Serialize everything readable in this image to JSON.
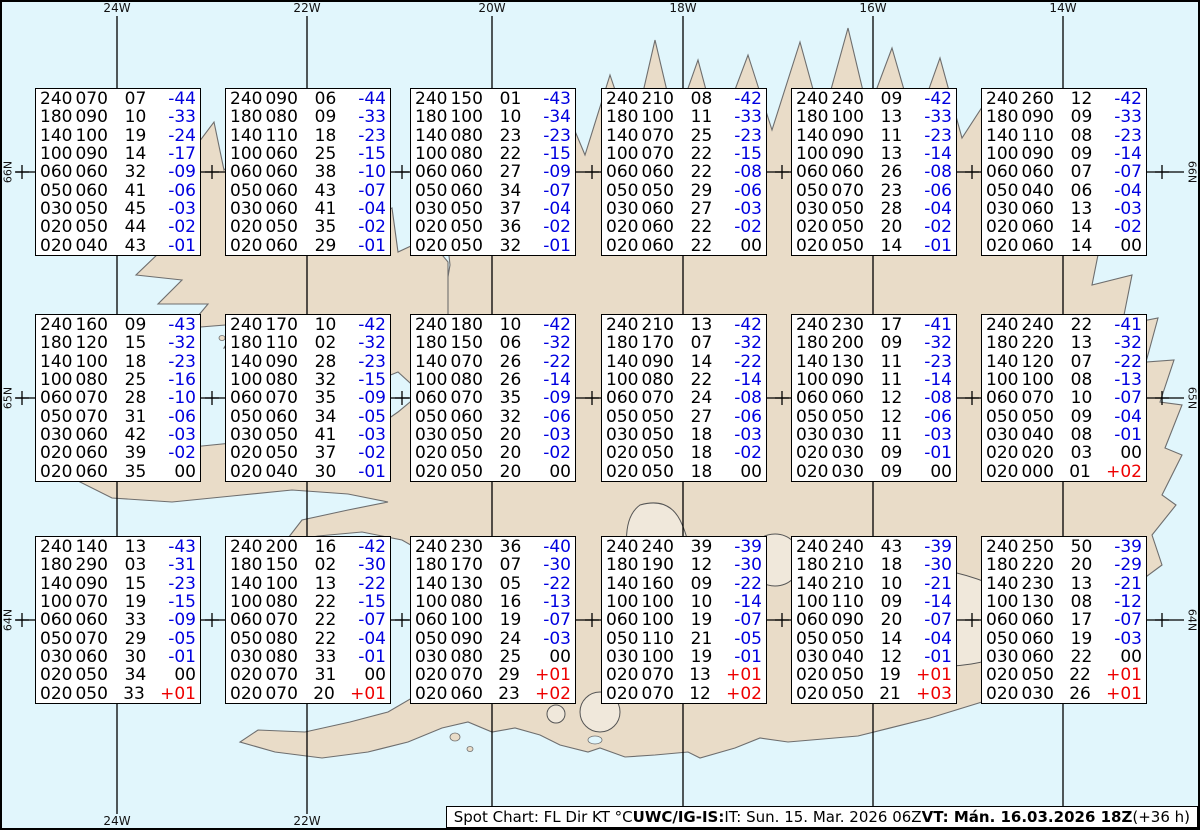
{
  "colors": {
    "ocean": "#e1f6fc",
    "land": "#e9dcc8",
    "coast": "#6e6e6e",
    "grid": "#000000",
    "temp_negative": "#0000e0",
    "temp_positive": "#ee0000",
    "temp_zero": "#000000",
    "box_background": "#ffffff",
    "box_border": "#000000"
  },
  "axis": {
    "meridians": [
      {
        "label": "24W",
        "x": 117
      },
      {
        "label": "22W",
        "x": 307
      },
      {
        "label": "20W",
        "x": 492
      },
      {
        "label": "18W",
        "x": 683
      },
      {
        "label": "16W",
        "x": 873
      },
      {
        "label": "14W",
        "x": 1063
      }
    ],
    "parallels": [
      {
        "label": "66N",
        "y": 172
      },
      {
        "label": "65N",
        "y": 398
      },
      {
        "label": "64N",
        "y": 620
      }
    ],
    "minor_cross_xs": [
      22,
      212,
      402,
      592,
      782,
      972,
      1162
    ]
  },
  "chart_data": {
    "type": "table",
    "title": "Spot Chart: FL Dir KT °C",
    "columns": [
      "FL",
      "Dir",
      "KT",
      "°C"
    ],
    "lon_labels": [
      "24W",
      "22W",
      "20W",
      "18W",
      "16W",
      "14W"
    ],
    "lat_labels": [
      "66N",
      "65N",
      "64N"
    ],
    "boxes": [
      {
        "lat": "66N",
        "lon": "24W",
        "rows": [
          [
            "240",
            "070",
            "07",
            "-44"
          ],
          [
            "180",
            "090",
            "10",
            "-33"
          ],
          [
            "140",
            "100",
            "19",
            "-24"
          ],
          [
            "100",
            "090",
            "14",
            "-17"
          ],
          [
            "060",
            "060",
            "32",
            "-09"
          ],
          [
            "050",
            "060",
            "41",
            "-06"
          ],
          [
            "030",
            "050",
            "45",
            "-03"
          ],
          [
            "020",
            "050",
            "44",
            "-02"
          ],
          [
            "020",
            "040",
            "43",
            "-01"
          ]
        ]
      },
      {
        "lat": "66N",
        "lon": "22W",
        "rows": [
          [
            "240",
            "090",
            "06",
            "-44"
          ],
          [
            "180",
            "080",
            "09",
            "-33"
          ],
          [
            "140",
            "110",
            "18",
            "-23"
          ],
          [
            "100",
            "060",
            "25",
            "-15"
          ],
          [
            "060",
            "060",
            "38",
            "-10"
          ],
          [
            "050",
            "060",
            "43",
            "-07"
          ],
          [
            "030",
            "060",
            "41",
            "-04"
          ],
          [
            "020",
            "050",
            "35",
            "-02"
          ],
          [
            "020",
            "060",
            "29",
            "-01"
          ]
        ]
      },
      {
        "lat": "66N",
        "lon": "20W",
        "rows": [
          [
            "240",
            "150",
            "01",
            "-43"
          ],
          [
            "180",
            "100",
            "10",
            "-34"
          ],
          [
            "140",
            "080",
            "23",
            "-23"
          ],
          [
            "100",
            "080",
            "22",
            "-15"
          ],
          [
            "060",
            "060",
            "27",
            "-09"
          ],
          [
            "050",
            "060",
            "34",
            "-07"
          ],
          [
            "030",
            "050",
            "37",
            "-04"
          ],
          [
            "020",
            "050",
            "36",
            "-02"
          ],
          [
            "020",
            "050",
            "32",
            "-01"
          ]
        ]
      },
      {
        "lat": "66N",
        "lon": "18W",
        "rows": [
          [
            "240",
            "210",
            "08",
            "-42"
          ],
          [
            "180",
            "100",
            "11",
            "-33"
          ],
          [
            "140",
            "070",
            "25",
            "-23"
          ],
          [
            "100",
            "070",
            "22",
            "-15"
          ],
          [
            "060",
            "060",
            "22",
            "-08"
          ],
          [
            "050",
            "050",
            "29",
            "-06"
          ],
          [
            "030",
            "060",
            "27",
            "-03"
          ],
          [
            "020",
            "060",
            "22",
            "-02"
          ],
          [
            "020",
            "060",
            "22",
            "00"
          ]
        ]
      },
      {
        "lat": "66N",
        "lon": "16W",
        "rows": [
          [
            "240",
            "240",
            "09",
            "-42"
          ],
          [
            "180",
            "100",
            "13",
            "-33"
          ],
          [
            "140",
            "090",
            "11",
            "-23"
          ],
          [
            "100",
            "090",
            "13",
            "-14"
          ],
          [
            "060",
            "060",
            "26",
            "-08"
          ],
          [
            "050",
            "070",
            "23",
            "-06"
          ],
          [
            "030",
            "050",
            "28",
            "-04"
          ],
          [
            "020",
            "050",
            "20",
            "-02"
          ],
          [
            "020",
            "050",
            "14",
            "-01"
          ]
        ]
      },
      {
        "lat": "66N",
        "lon": "14W",
        "rows": [
          [
            "240",
            "260",
            "12",
            "-42"
          ],
          [
            "180",
            "090",
            "09",
            "-33"
          ],
          [
            "140",
            "110",
            "08",
            "-23"
          ],
          [
            "100",
            "090",
            "09",
            "-14"
          ],
          [
            "060",
            "060",
            "07",
            "-07"
          ],
          [
            "050",
            "040",
            "06",
            "-04"
          ],
          [
            "030",
            "060",
            "13",
            "-03"
          ],
          [
            "020",
            "060",
            "14",
            "-02"
          ],
          [
            "020",
            "060",
            "14",
            "00"
          ]
        ]
      },
      {
        "lat": "65N",
        "lon": "24W",
        "rows": [
          [
            "240",
            "160",
            "09",
            "-43"
          ],
          [
            "180",
            "120",
            "15",
            "-32"
          ],
          [
            "140",
            "100",
            "18",
            "-23"
          ],
          [
            "100",
            "080",
            "25",
            "-16"
          ],
          [
            "060",
            "070",
            "28",
            "-10"
          ],
          [
            "050",
            "070",
            "31",
            "-06"
          ],
          [
            "030",
            "060",
            "42",
            "-03"
          ],
          [
            "020",
            "060",
            "39",
            "-02"
          ],
          [
            "020",
            "060",
            "35",
            "00"
          ]
        ]
      },
      {
        "lat": "65N",
        "lon": "22W",
        "rows": [
          [
            "240",
            "170",
            "10",
            "-42"
          ],
          [
            "180",
            "110",
            "02",
            "-32"
          ],
          [
            "140",
            "090",
            "28",
            "-23"
          ],
          [
            "100",
            "080",
            "32",
            "-15"
          ],
          [
            "060",
            "070",
            "35",
            "-09"
          ],
          [
            "050",
            "060",
            "34",
            "-05"
          ],
          [
            "030",
            "050",
            "41",
            "-03"
          ],
          [
            "020",
            "050",
            "37",
            "-02"
          ],
          [
            "020",
            "040",
            "30",
            "-01"
          ]
        ]
      },
      {
        "lat": "65N",
        "lon": "20W",
        "rows": [
          [
            "240",
            "180",
            "10",
            "-42"
          ],
          [
            "180",
            "150",
            "06",
            "-32"
          ],
          [
            "140",
            "070",
            "26",
            "-22"
          ],
          [
            "100",
            "080",
            "26",
            "-14"
          ],
          [
            "060",
            "070",
            "35",
            "-09"
          ],
          [
            "050",
            "060",
            "32",
            "-06"
          ],
          [
            "030",
            "050",
            "20",
            "-03"
          ],
          [
            "020",
            "050",
            "20",
            "-02"
          ],
          [
            "020",
            "050",
            "20",
            "00"
          ]
        ]
      },
      {
        "lat": "65N",
        "lon": "18W",
        "rows": [
          [
            "240",
            "210",
            "13",
            "-42"
          ],
          [
            "180",
            "170",
            "07",
            "-32"
          ],
          [
            "140",
            "090",
            "14",
            "-22"
          ],
          [
            "100",
            "080",
            "22",
            "-14"
          ],
          [
            "060",
            "070",
            "24",
            "-08"
          ],
          [
            "050",
            "050",
            "27",
            "-06"
          ],
          [
            "030",
            "050",
            "18",
            "-03"
          ],
          [
            "020",
            "050",
            "18",
            "-02"
          ],
          [
            "020",
            "050",
            "18",
            "00"
          ]
        ]
      },
      {
        "lat": "65N",
        "lon": "16W",
        "rows": [
          [
            "240",
            "230",
            "17",
            "-41"
          ],
          [
            "180",
            "200",
            "09",
            "-32"
          ],
          [
            "140",
            "130",
            "11",
            "-23"
          ],
          [
            "100",
            "090",
            "11",
            "-14"
          ],
          [
            "060",
            "060",
            "12",
            "-08"
          ],
          [
            "050",
            "050",
            "12",
            "-06"
          ],
          [
            "030",
            "030",
            "11",
            "-03"
          ],
          [
            "020",
            "030",
            "09",
            "-01"
          ],
          [
            "020",
            "030",
            "09",
            "00"
          ]
        ]
      },
      {
        "lat": "65N",
        "lon": "14W",
        "rows": [
          [
            "240",
            "240",
            "22",
            "-41"
          ],
          [
            "180",
            "220",
            "13",
            "-32"
          ],
          [
            "140",
            "120",
            "07",
            "-22"
          ],
          [
            "100",
            "100",
            "08",
            "-13"
          ],
          [
            "060",
            "070",
            "10",
            "-07"
          ],
          [
            "050",
            "050",
            "09",
            "-04"
          ],
          [
            "030",
            "040",
            "08",
            "-01"
          ],
          [
            "020",
            "020",
            "03",
            "00"
          ],
          [
            "020",
            "000",
            "01",
            "+02"
          ]
        ]
      },
      {
        "lat": "64N",
        "lon": "24W",
        "rows": [
          [
            "240",
            "140",
            "13",
            "-43"
          ],
          [
            "180",
            "290",
            "03",
            "-31"
          ],
          [
            "140",
            "090",
            "15",
            "-23"
          ],
          [
            "100",
            "070",
            "19",
            "-15"
          ],
          [
            "060",
            "060",
            "33",
            "-09"
          ],
          [
            "050",
            "070",
            "29",
            "-05"
          ],
          [
            "030",
            "060",
            "30",
            "-01"
          ],
          [
            "020",
            "050",
            "34",
            "00"
          ],
          [
            "020",
            "050",
            "33",
            "+01"
          ]
        ]
      },
      {
        "lat": "64N",
        "lon": "22W",
        "rows": [
          [
            "240",
            "200",
            "16",
            "-42"
          ],
          [
            "180",
            "150",
            "02",
            "-30"
          ],
          [
            "140",
            "100",
            "13",
            "-22"
          ],
          [
            "100",
            "080",
            "22",
            "-15"
          ],
          [
            "060",
            "070",
            "22",
            "-07"
          ],
          [
            "050",
            "080",
            "22",
            "-04"
          ],
          [
            "030",
            "080",
            "33",
            "-01"
          ],
          [
            "020",
            "070",
            "31",
            "00"
          ],
          [
            "020",
            "070",
            "20",
            "+01"
          ]
        ]
      },
      {
        "lat": "64N",
        "lon": "20W",
        "rows": [
          [
            "240",
            "230",
            "36",
            "-40"
          ],
          [
            "180",
            "170",
            "07",
            "-30"
          ],
          [
            "140",
            "130",
            "05",
            "-22"
          ],
          [
            "100",
            "080",
            "16",
            "-13"
          ],
          [
            "060",
            "100",
            "19",
            "-07"
          ],
          [
            "050",
            "090",
            "24",
            "-03"
          ],
          [
            "030",
            "080",
            "25",
            "00"
          ],
          [
            "020",
            "070",
            "29",
            "+01"
          ],
          [
            "020",
            "060",
            "23",
            "+02"
          ]
        ]
      },
      {
        "lat": "64N",
        "lon": "18W",
        "rows": [
          [
            "240",
            "240",
            "39",
            "-39"
          ],
          [
            "180",
            "190",
            "12",
            "-30"
          ],
          [
            "140",
            "160",
            "09",
            "-22"
          ],
          [
            "100",
            "100",
            "10",
            "-14"
          ],
          [
            "060",
            "100",
            "19",
            "-07"
          ],
          [
            "050",
            "110",
            "21",
            "-05"
          ],
          [
            "030",
            "100",
            "19",
            "-01"
          ],
          [
            "020",
            "070",
            "13",
            "+01"
          ],
          [
            "020",
            "070",
            "12",
            "+02"
          ]
        ]
      },
      {
        "lat": "64N",
        "lon": "16W",
        "rows": [
          [
            "240",
            "240",
            "43",
            "-39"
          ],
          [
            "180",
            "210",
            "18",
            "-30"
          ],
          [
            "140",
            "210",
            "10",
            "-21"
          ],
          [
            "100",
            "110",
            "09",
            "-14"
          ],
          [
            "060",
            "090",
            "20",
            "-07"
          ],
          [
            "050",
            "050",
            "14",
            "-04"
          ],
          [
            "030",
            "040",
            "12",
            "-01"
          ],
          [
            "020",
            "050",
            "19",
            "+01"
          ],
          [
            "020",
            "050",
            "21",
            "+03"
          ]
        ]
      },
      {
        "lat": "64N",
        "lon": "14W",
        "rows": [
          [
            "240",
            "250",
            "50",
            "-39"
          ],
          [
            "180",
            "220",
            "20",
            "-29"
          ],
          [
            "140",
            "230",
            "13",
            "-21"
          ],
          [
            "100",
            "130",
            "08",
            "-12"
          ],
          [
            "060",
            "060",
            "17",
            "-07"
          ],
          [
            "050",
            "060",
            "19",
            "-03"
          ],
          [
            "030",
            "060",
            "22",
            "00"
          ],
          [
            "020",
            "050",
            "22",
            "+01"
          ],
          [
            "020",
            "030",
            "26",
            "+01"
          ]
        ]
      }
    ]
  },
  "caption": {
    "prefix": "Spot Chart: FL Dir KT °C ",
    "center_bold": "UWC/IG-IS:",
    "issue": " IT: Sun. 15. Mar. 2026 06Z ",
    "valid_bold": "VT: Mán. 16.03.2026 18Z",
    "suffix": " (+36 h)"
  }
}
